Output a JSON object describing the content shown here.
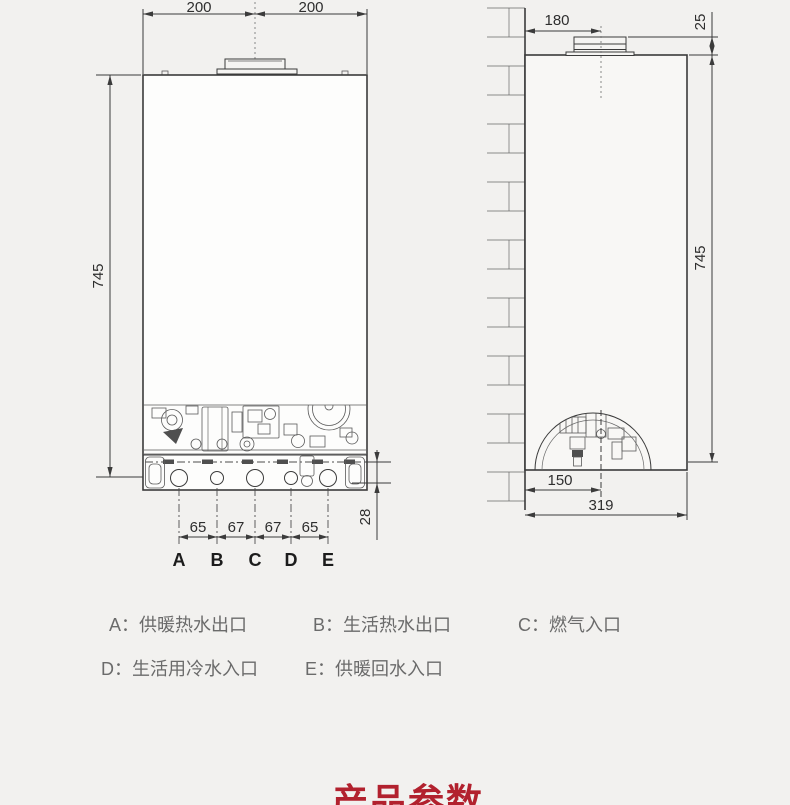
{
  "page": {
    "background": "#f2f1ef",
    "line_color": "#3b3b3b",
    "text_gray": "#6b6b6b",
    "accent_red": "#b2212e"
  },
  "front_view": {
    "dims": {
      "top_left": "200",
      "top_right": "200",
      "height": "745",
      "spacing_ab": "65",
      "spacing_bc": "67",
      "spacing_cd": "67",
      "spacing_de": "65",
      "bottom_clearance": "28"
    },
    "ports": [
      "A",
      "B",
      "C",
      "D",
      "E"
    ]
  },
  "side_view": {
    "dims": {
      "flue_to_wall": "180",
      "collar_height": "25",
      "height": "745",
      "wall_to_pipes": "150",
      "depth": "319"
    }
  },
  "legend": {
    "items": [
      {
        "text": "A：供暖热水出口"
      },
      {
        "text": "B：生活热水出口"
      },
      {
        "text": "C：燃气入口"
      },
      {
        "text": "D：生活用冷水入口"
      },
      {
        "text": "E：供暖回水入口"
      }
    ]
  },
  "title": {
    "text": "产品参数"
  }
}
